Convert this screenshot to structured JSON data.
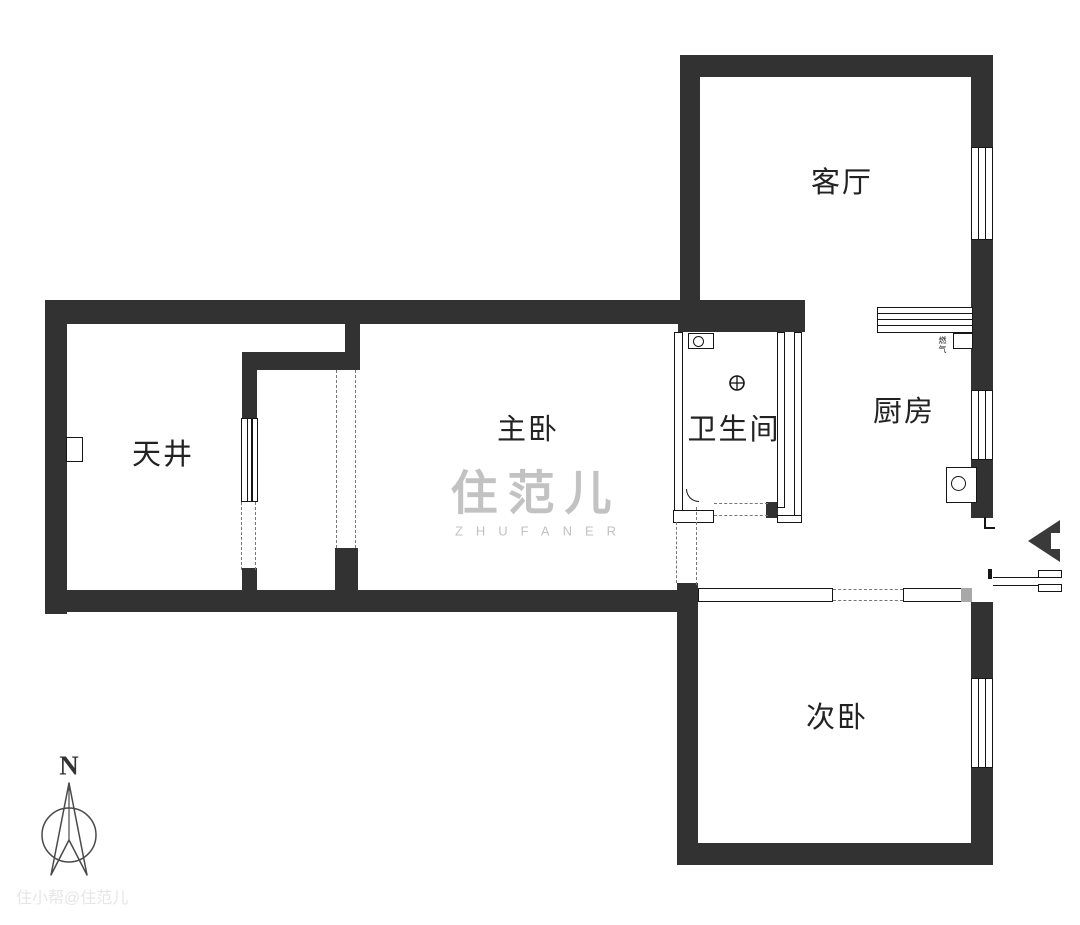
{
  "plan": {
    "rooms": {
      "living_room": {
        "label": "客厅"
      },
      "kitchen": {
        "label": "厨房"
      },
      "bathroom": {
        "label": "卫生间"
      },
      "master_bedroom": {
        "label": "主卧"
      },
      "secondary_bedroom": {
        "label": "次卧"
      },
      "light_well": {
        "label": "天井"
      }
    },
    "fixtures": {
      "gas_meter_label": "燃气"
    },
    "compass": {
      "north_label": "N"
    },
    "watermarks": {
      "center_logo": "住范儿",
      "center_latin": "ZHUFANER",
      "corner": "住小帮@住范儿"
    },
    "colors": {
      "wall": "#323232",
      "line": "#161616",
      "dash": "#777777",
      "label": "#222222",
      "watermark": "#c2c2c2",
      "corner_watermark": "#e6e6e6",
      "arrow": "#3a3a3a",
      "compass": "#4a4a4a"
    }
  }
}
